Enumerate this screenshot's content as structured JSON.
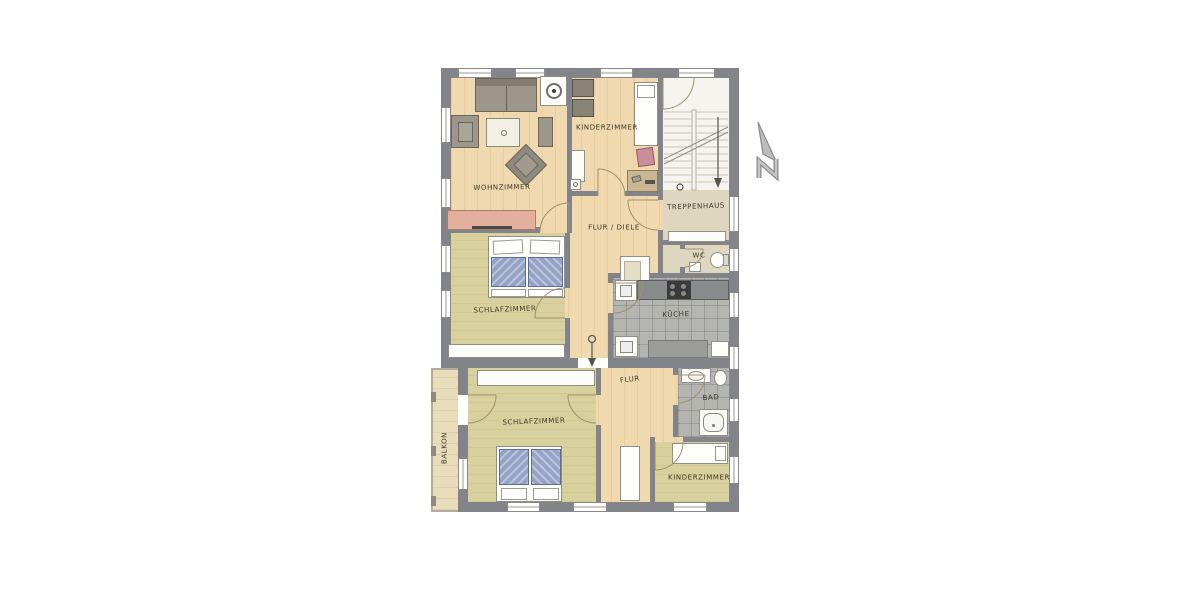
{
  "canvas": {
    "background": "#ffffff"
  },
  "rooms": [
    {
      "id": "wohnzimmer",
      "label": "WOHNZIMMER"
    },
    {
      "id": "kinderzimmer-top",
      "label": "KINDERZIMMER"
    },
    {
      "id": "treppenhaus",
      "label": "TREPPENHAUS"
    },
    {
      "id": "flur-diele",
      "label": "FLUR / DIELE"
    },
    {
      "id": "wc",
      "label": "WC"
    },
    {
      "id": "kueche",
      "label": "KÜCHE"
    },
    {
      "id": "schlafzimmer-upper",
      "label": "SCHLAFZIMMER"
    },
    {
      "id": "flur-lower",
      "label": "FLUR"
    },
    {
      "id": "bad",
      "label": "BAD"
    },
    {
      "id": "schlafzimmer-lower",
      "label": "SCHLAFZIMMER"
    },
    {
      "id": "balkon",
      "label": "BALKON"
    },
    {
      "id": "kinderzimmer-bottom",
      "label": "KINDERZIMMER"
    }
  ],
  "palette": {
    "wall": "#82848a",
    "wood_floor": "#f0d9ae",
    "olive_floor": "#d8d09d",
    "tile_floor": "#b4b4b0",
    "beige_floor": "#ded6bf",
    "stair_floor": "#f6f4ef",
    "balcony_floor": "#e8dcba",
    "furniture_gray": "#9c968b",
    "furniture_white": "#fdfdfa",
    "sideboard_pink": "#e2b09c",
    "mattress_blue": "#95a3c6",
    "counter_gray": "#898b8d",
    "door_arc": "#a3916c"
  }
}
